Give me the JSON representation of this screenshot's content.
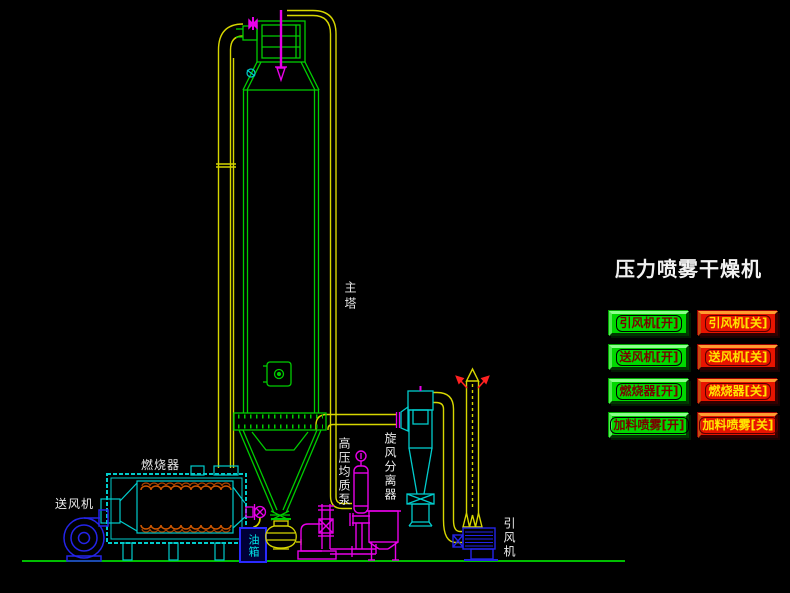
{
  "title": "压力喷雾干燥机",
  "colors": {
    "background": "#000000",
    "button_on": "#00D800",
    "button_off": "#E81400",
    "pipe_yellow": "#D6D600",
    "equipment_green": "#00CC00",
    "equipment_cyan": "#00CCCC",
    "equipment_magenta": "#E800E8",
    "fan_blue": "#2424E8",
    "label_white": "#EAEAEA",
    "oil_tank_label_cyan": "#00E4E4"
  },
  "diagram": {
    "labels": {
      "main_tower": "主塔",
      "burner": "燃烧器",
      "supply_fan": "送风机",
      "oil_tank": "油箱",
      "high_pressure_pump": "高压均质泵",
      "cyclone": "旋风分离器",
      "induced_fan": "引风机"
    }
  },
  "buttons": [
    {
      "label": "引风机[开]",
      "state": "on"
    },
    {
      "label": "引风机[关]",
      "state": "off"
    },
    {
      "label": "送风机[开]",
      "state": "on"
    },
    {
      "label": "送风机[关]",
      "state": "off"
    },
    {
      "label": "燃烧器[开]",
      "state": "on"
    },
    {
      "label": "燃烧器[关]",
      "state": "off"
    },
    {
      "label": "加料喷雾[开]",
      "state": "on"
    },
    {
      "label": "加料喷雾[关]",
      "state": "off"
    }
  ]
}
